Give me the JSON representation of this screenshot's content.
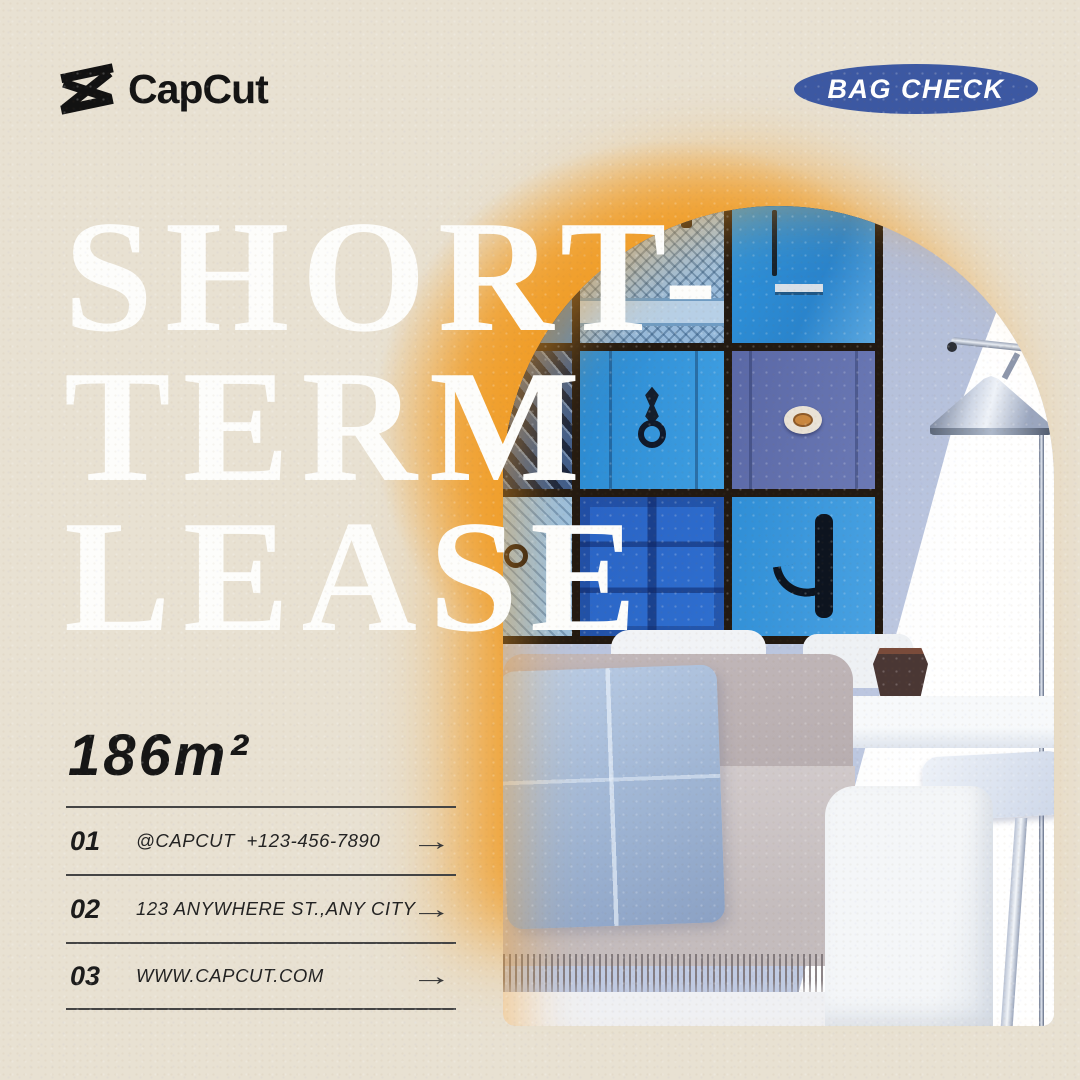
{
  "header": {
    "logo_text": "CapCut",
    "badge_label": "BAG CHECK"
  },
  "headline": {
    "line1": "SHORT-",
    "line2": "TERM",
    "line3": "LEASE"
  },
  "area_label": "186m²",
  "list": {
    "arrow_glyph": "→",
    "rows": [
      {
        "num": "01",
        "text": "@CAPCUT  +123-456-7890"
      },
      {
        "num": "02",
        "text": "123 ANYWHERE ST.,ANY CITY"
      },
      {
        "num": "03",
        "text": "WWW.CAPCUT.COM"
      }
    ]
  },
  "colors": {
    "background_beige": "#e8e1d2",
    "glow_orange": "#f09d28",
    "badge_blue": "#3c58a2",
    "headline_white": "#fdfdfb",
    "text_black": "#1b1b1b",
    "wall_periwinkle": "#b9c4de",
    "frame_brown": "#221911",
    "door_blue_bright": "#2f94dc",
    "door_blue_navy": "#1f3256",
    "door_blue_slate": "#5a68a6",
    "door_blue_cobalt": "#2a63c4",
    "sofa_gray": "#c4bcbd",
    "pillow_blue": "#9db3d2"
  }
}
